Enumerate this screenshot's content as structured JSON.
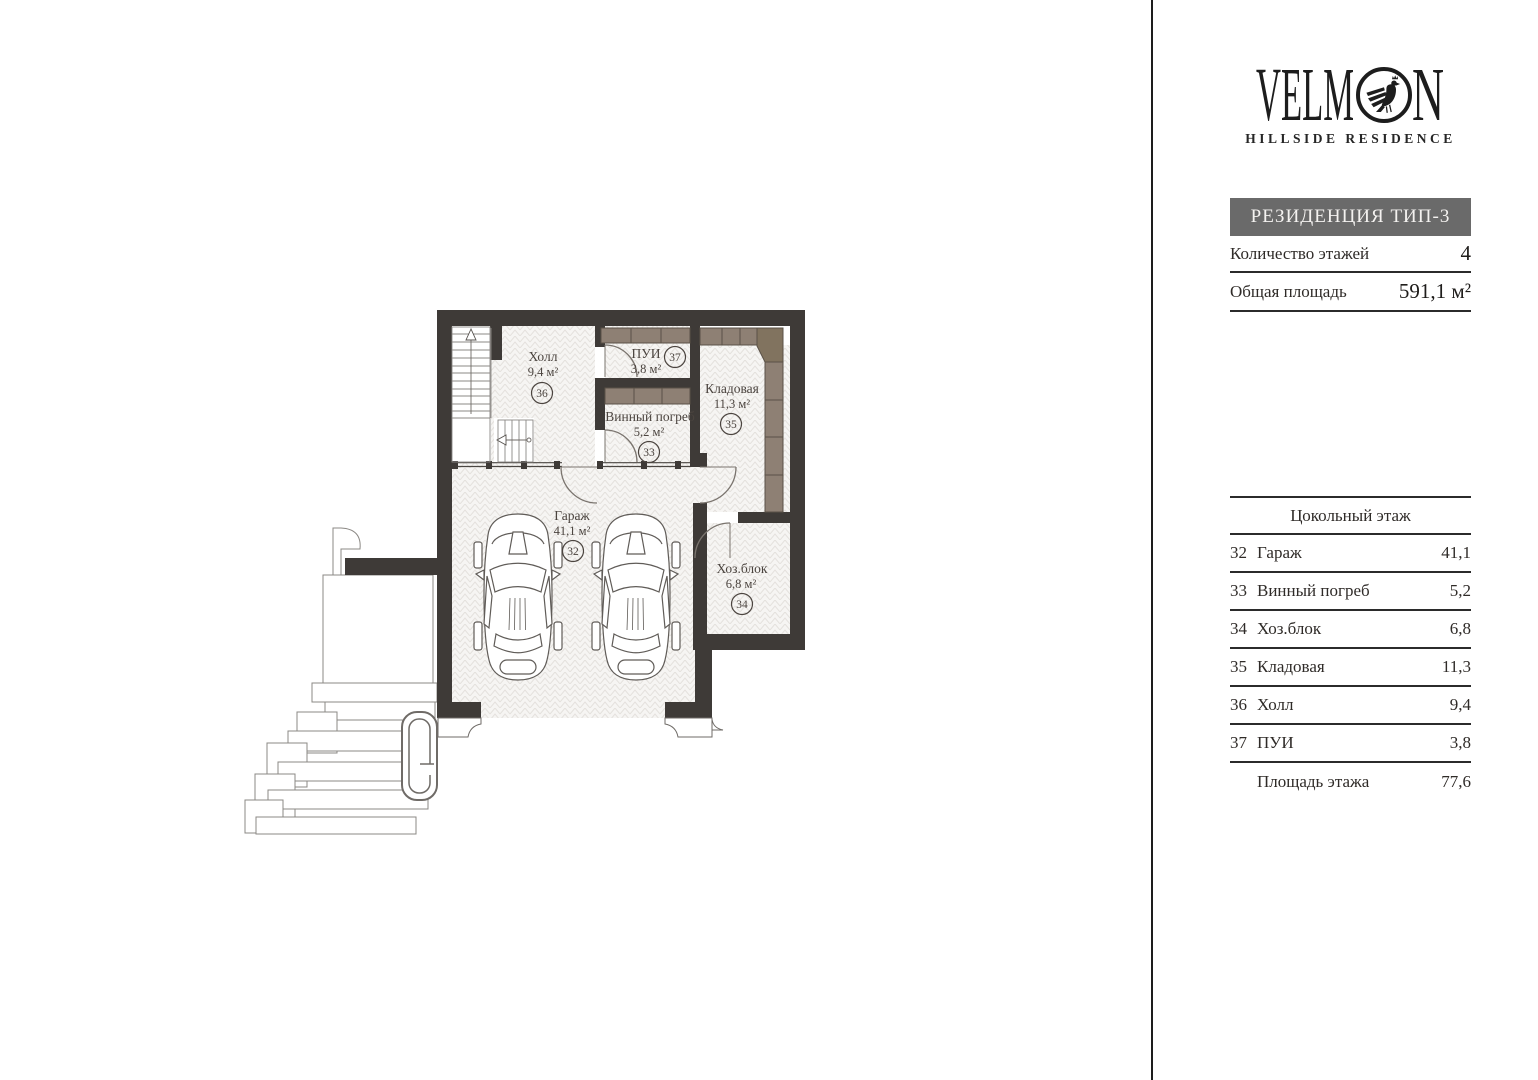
{
  "brand": {
    "full": "VELMON",
    "left": "VELM",
    "right": "N",
    "subtitle": "HILLSIDE RESIDENCE"
  },
  "sidebar": {
    "type_header": "РЕЗИДЕНЦИЯ ТИП-3",
    "info": [
      {
        "label": "Количество этажей",
        "value": "4"
      },
      {
        "label": "Общая площадь",
        "value": "591,1 м²"
      }
    ],
    "legend": {
      "floor_title": "Цокольный этаж",
      "summary_label": "Площадь этажа",
      "summary_value": "77,6"
    }
  },
  "rooms": [
    {
      "num": "32",
      "name": "Гараж",
      "area": "41,1",
      "area_m2": "41,1 м²"
    },
    {
      "num": "33",
      "name": "Винный погреб",
      "area": "5,2",
      "area_m2": "5,2 м²"
    },
    {
      "num": "34",
      "name": "Хоз.блок",
      "area": "6,8",
      "area_m2": "6,8 м²"
    },
    {
      "num": "35",
      "name": "Кладовая",
      "area": "11,3",
      "area_m2": "11,3 м²"
    },
    {
      "num": "36",
      "name": "Холл",
      "area": "9,4",
      "area_m2": "9,4 м²"
    },
    {
      "num": "37",
      "name": "ПУИ",
      "area": "3,8",
      "area_m2": "3,8 м²"
    }
  ],
  "colors": {
    "wall": "#3e3a37",
    "cabinet": "#8e8074",
    "cabinet_dark": "#81735f",
    "floor": "#f6f5f3",
    "hatch_line": "#e4e1dd",
    "header_box": "#6a6a6a",
    "ink": "#1d1d1d",
    "label": "#4b443f"
  }
}
